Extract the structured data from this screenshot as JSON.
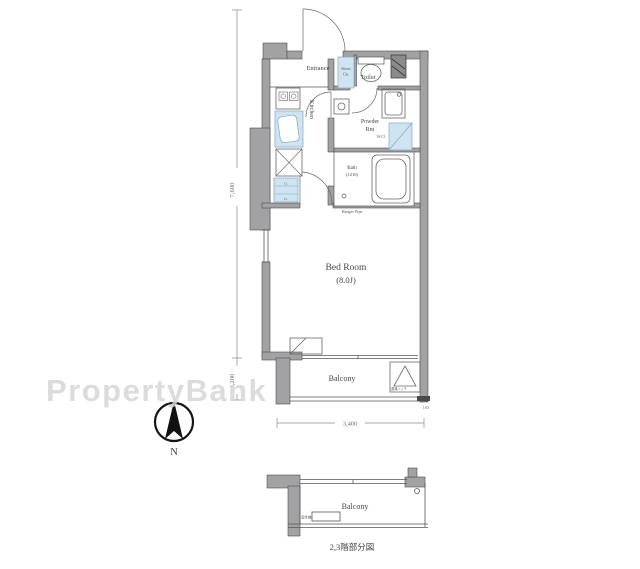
{
  "plan": {
    "rooms": {
      "entrance": "Entrance",
      "toilet": "Toilet",
      "kitchen": "Kitchen",
      "powder_1": "Powder",
      "powder_2": "Rm",
      "bath_1": "Bath",
      "bath_2": "(1216)",
      "bedroom_1": "Bed Room",
      "bedroom_2": "(8.0J)",
      "balcony": "Balcony",
      "balcony_lower": "Balcony"
    },
    "fixtures": {
      "shoes_1": "Shoes",
      "shoes_2": "Cls.",
      "wcl": "W.Cl",
      "hanger": "Hanger Pipe",
      "closet_small_1": "Cl.",
      "closet_small_2": "Cl.",
      "hatch": "避難ハッチ",
      "outdoor_unit": "室外機"
    },
    "dimensions": {
      "height_main": "7,600",
      "height_balcony": "1,200",
      "width": "3,400",
      "right_small": "103"
    },
    "compass": "N",
    "caption": "2,3階部分図",
    "watermark": "PropertyBank"
  }
}
